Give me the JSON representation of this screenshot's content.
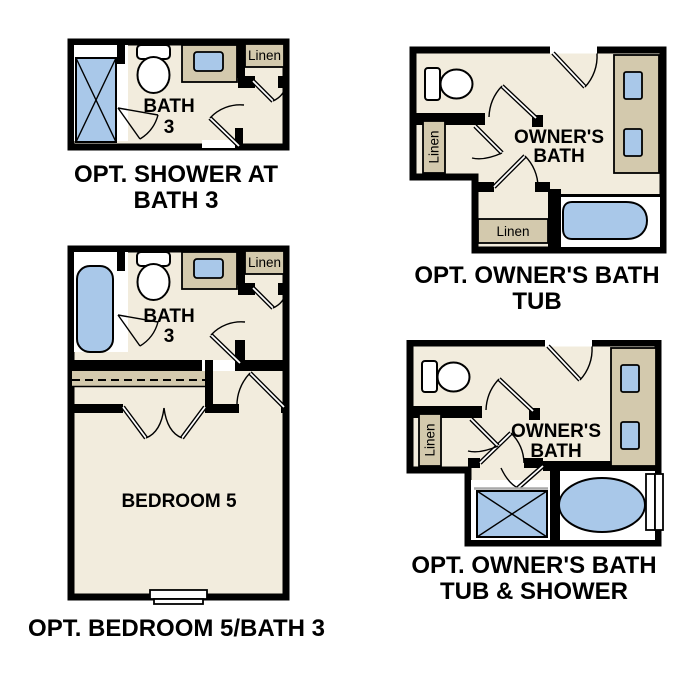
{
  "colors": {
    "page_bg": "#ffffff",
    "wall": "#000000",
    "floor": "#f2ecdd",
    "cabinet": "#d3c9ad",
    "fixture": "#a9c8e9",
    "text": "#000000"
  },
  "plans": {
    "bath3_shower": {
      "caption_line1": "OPT. SHOWER AT",
      "caption_line2": "BATH 3",
      "room_label_line1": "BATH",
      "room_label_line2": "3",
      "linen_label": "Linen"
    },
    "owners_bath_tub": {
      "caption_line1": "OPT. OWNER'S BATH",
      "caption_line2": "TUB",
      "room_label_line1": "OWNER'S",
      "room_label_line2": "BATH",
      "linen_left_label": "Linen",
      "linen_bottom_label": "Linen"
    },
    "bedroom5_bath3": {
      "caption": "OPT. BEDROOM 5/BATH 3",
      "bath_label_line1": "BATH",
      "bath_label_line2": "3",
      "bedroom_label": "BEDROOM 5",
      "linen_label": "Linen"
    },
    "owners_bath_tub_shower": {
      "caption_line1": "OPT. OWNER'S BATH",
      "caption_line2": "TUB & SHOWER",
      "room_label_line1": "OWNER'S",
      "room_label_line2": "BATH",
      "linen_label": "Linen"
    }
  }
}
